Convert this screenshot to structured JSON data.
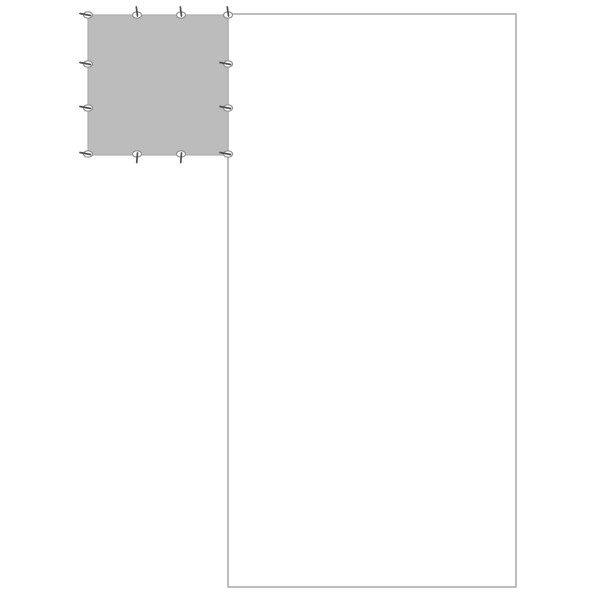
{
  "canvas": {
    "width": 600,
    "height": 600,
    "background_color": "#ffffff"
  },
  "diagram": {
    "outer_rectangle": {
      "x": 228,
      "y": 14,
      "width": 288,
      "height": 573,
      "fill": "none",
      "stroke": "#a8a8a8",
      "stroke_width": 1.5
    },
    "gray_square": {
      "x": 88,
      "y": 15,
      "width": 140,
      "height": 140,
      "fill": "#bcbcbc",
      "stroke": "#aeaeae",
      "stroke_width": 1.2
    },
    "pin_handles": {
      "ellipse_fill": "#ffffff",
      "ellipse_stroke": "#8f8f8f",
      "ellipse_stroke_width": 1.2,
      "ellipse_rx": 4.5,
      "ellipse_ry": 3.2,
      "tail_color": "#4f4f4f",
      "tail_width": 1.7,
      "points": [
        {
          "x": 88,
          "y": 15,
          "dir": "left"
        },
        {
          "x": 137,
          "y": 15,
          "dir": "up"
        },
        {
          "x": 181,
          "y": 15,
          "dir": "up"
        },
        {
          "x": 228,
          "y": 15,
          "dir": "up"
        },
        {
          "x": 88,
          "y": 64,
          "dir": "left"
        },
        {
          "x": 228,
          "y": 64,
          "dir": "left"
        },
        {
          "x": 88,
          "y": 108,
          "dir": "left"
        },
        {
          "x": 228,
          "y": 108,
          "dir": "left"
        },
        {
          "x": 88,
          "y": 154,
          "dir": "left"
        },
        {
          "x": 137,
          "y": 154,
          "dir": "down"
        },
        {
          "x": 181,
          "y": 154,
          "dir": "down"
        },
        {
          "x": 228,
          "y": 154,
          "dir": "left"
        }
      ]
    }
  }
}
